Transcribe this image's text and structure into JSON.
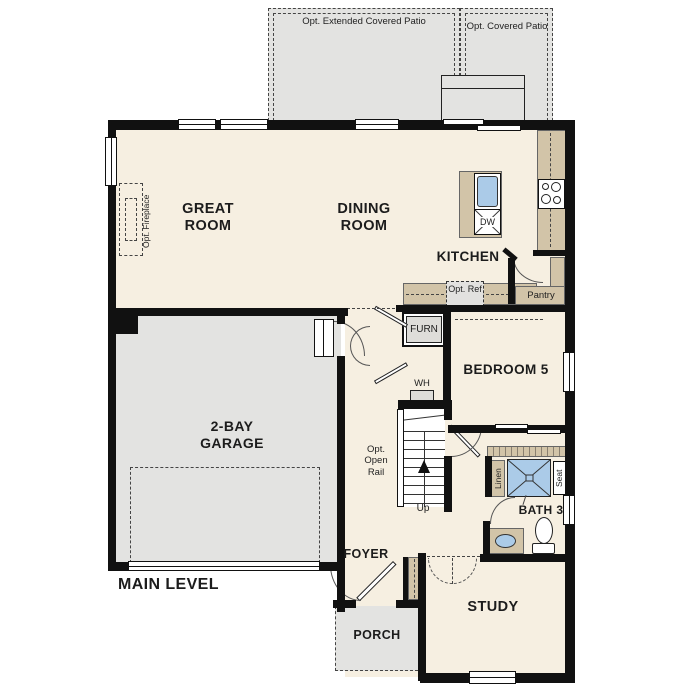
{
  "plan_title": "MAIN LEVEL",
  "outdoor": {
    "patio_extended": "Opt. Extended Covered Patio",
    "patio_covered": "Opt. Covered Patio",
    "porch": "PORCH"
  },
  "rooms": {
    "great_room": "GREAT ROOM",
    "dining_room": "DINING ROOM",
    "kitchen": "KITCHEN",
    "pantry": "Pantry",
    "bedroom_5": "BEDROOM 5",
    "bath_3": "BATH 3",
    "study": "STUDY",
    "foyer": "FOYER",
    "garage": "2-BAY GARAGE"
  },
  "features": {
    "opt_fireplace": "Opt. Fireplace",
    "furnace": "FURN",
    "water_heater": "WH",
    "dishwasher": "DW",
    "opt_ref": "Opt. Ref",
    "opt_open_rail": "Opt. Open Rail",
    "up": "Up",
    "linen": "Linen",
    "seat": "Seat"
  },
  "colors": {
    "wall": "#111111",
    "interior": "#f6efe1",
    "outdoor_gray": "#e3e3e1",
    "counter_tan": "#d2c4a8",
    "fixture_blue": "#abcbe8",
    "appliance_gray": "#deddd9"
  }
}
